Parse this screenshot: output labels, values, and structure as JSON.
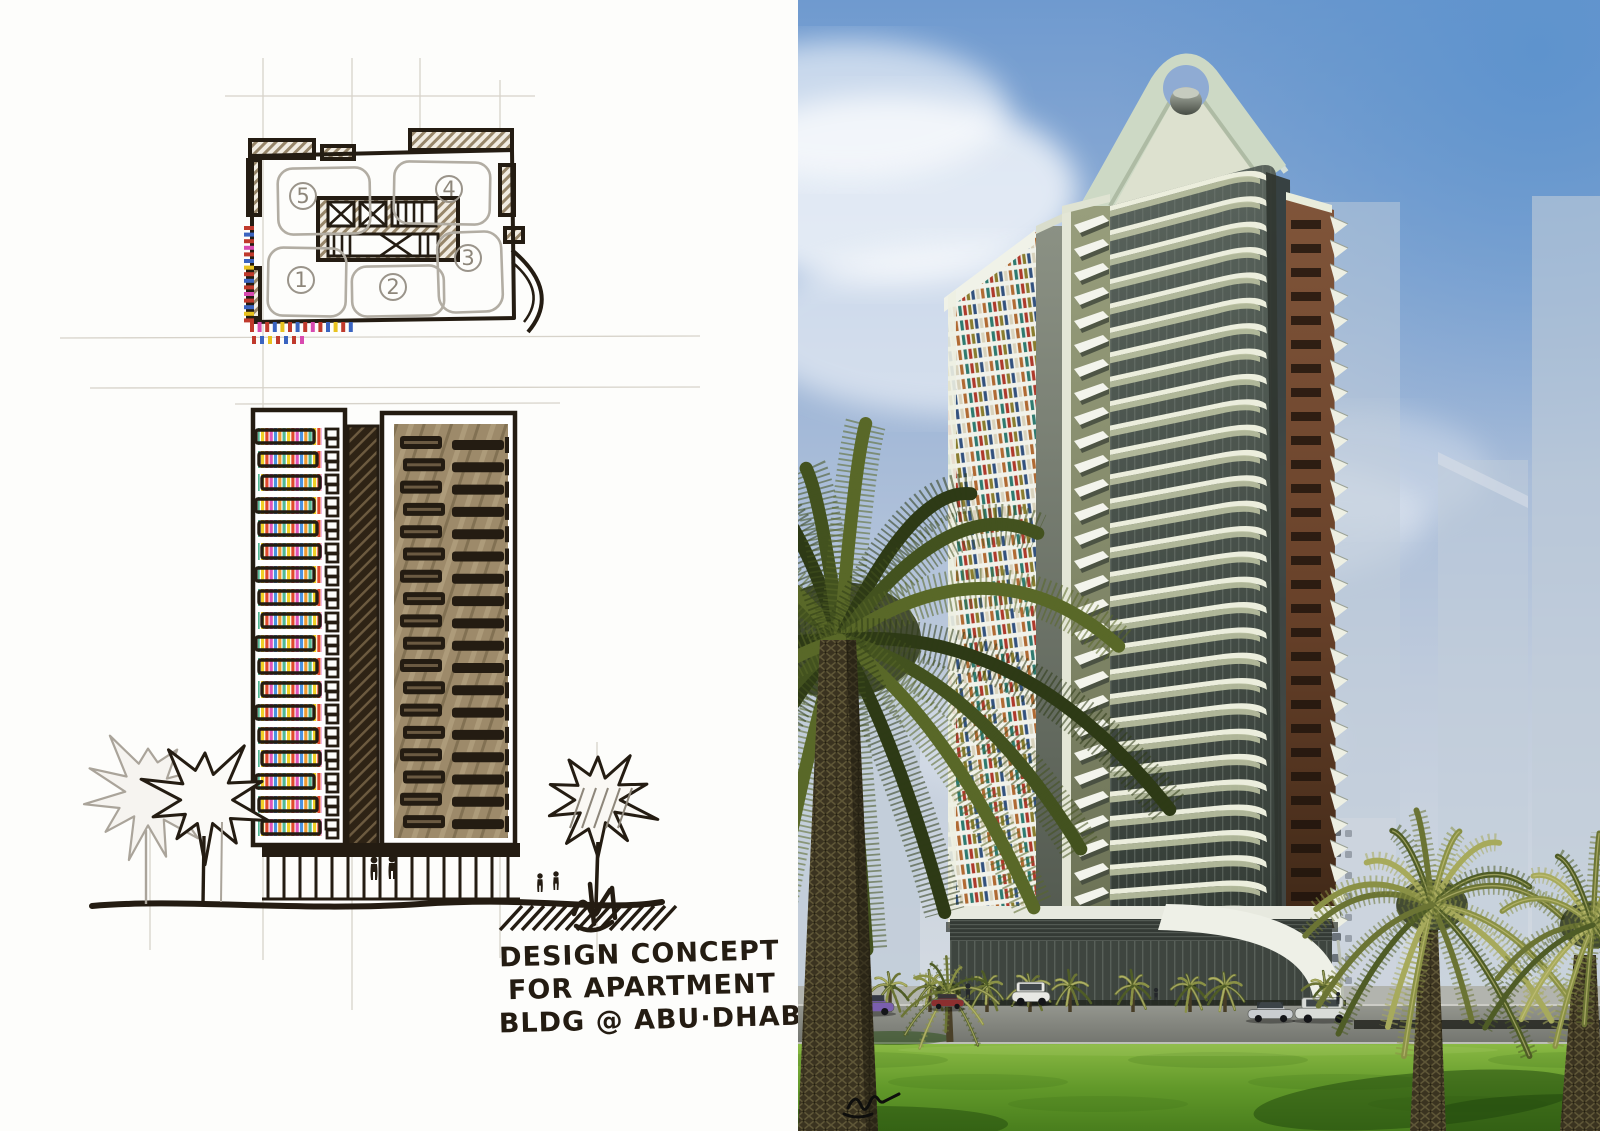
{
  "board": {
    "left_panel": "concept-sketch",
    "right_panel": "photorealistic-rendering"
  },
  "sketch": {
    "caption_lines": [
      "DESIGN CONCEPT",
      "FOR APARTMENT",
      "BLDG @ ABU·DHABI"
    ],
    "plan_room_labels": [
      "5",
      "4",
      "3",
      "1",
      "2"
    ],
    "elevation_rows": 18,
    "palette": {
      "ink": "#241c12",
      "pencil": "#b2ada3",
      "sepia": "#9d8a6a",
      "marker_stripes": [
        "#f0cf25",
        "#e0492c",
        "#e055b8",
        "#4a92e0",
        "#f09a30",
        "#52b894"
      ]
    }
  },
  "render": {
    "main_floors": 30,
    "brown_floors": 30,
    "zig_floors": 30,
    "wing_window_colors": [
      "#2f7a70",
      "#ae3a2c",
      "#8a7d2f",
      "#32517e",
      "#d8d2bc",
      "#b06a33"
    ],
    "palette": {
      "sky_deep": "#5e93cd",
      "sky_pale": "#d5dbe1",
      "crown_concrete": "#cdd9c5",
      "balcony_cream": "#eceedd",
      "balcony_rail": "#b9bfa0",
      "glass_dark": "#39413b",
      "brown_wing": "#6a4228",
      "grass_light": "#8ab944",
      "grass_dark": "#497e1d",
      "street": "#8f918c",
      "palm_green": "#55662c",
      "palm_trunk": "#3a3320",
      "ghost_building": "#c2cdd9"
    }
  }
}
